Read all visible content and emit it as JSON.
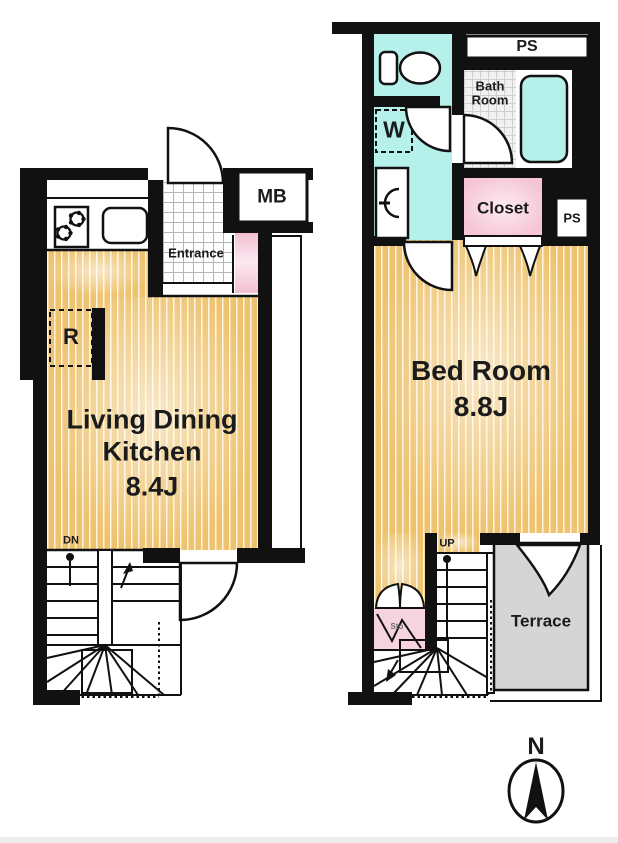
{
  "window": {
    "width": 618,
    "height": 843
  },
  "colors": {
    "wall": "#111111",
    "wood_floor": "#eec26e",
    "wet_area_cyan": "#b6f0ea",
    "closet_pink": "#f5c5d6",
    "storage_pink": "#f7d3e0",
    "terrace_grey": "#d5d5d5",
    "line": "#111111"
  },
  "floor1": {
    "labels": {
      "meter_box": "MB",
      "entrance": "Entrance",
      "refrigerator": "R",
      "room_line1": "Living Dining",
      "room_line2": "Kitchen",
      "room_size": "8.4J",
      "stairs_down": "DN"
    }
  },
  "floor2": {
    "labels": {
      "pipe_space_top": "PS",
      "bath_line1": "Bath",
      "bath_line2": "Room",
      "washer": "W",
      "closet": "Closet",
      "pipe_space_side": "PS",
      "room_name": "Bed Room",
      "room_size": "8.8J",
      "stairs_up": "UP",
      "storage": "Sto",
      "terrace": "Terrace"
    }
  },
  "compass": {
    "north_label": "N"
  }
}
